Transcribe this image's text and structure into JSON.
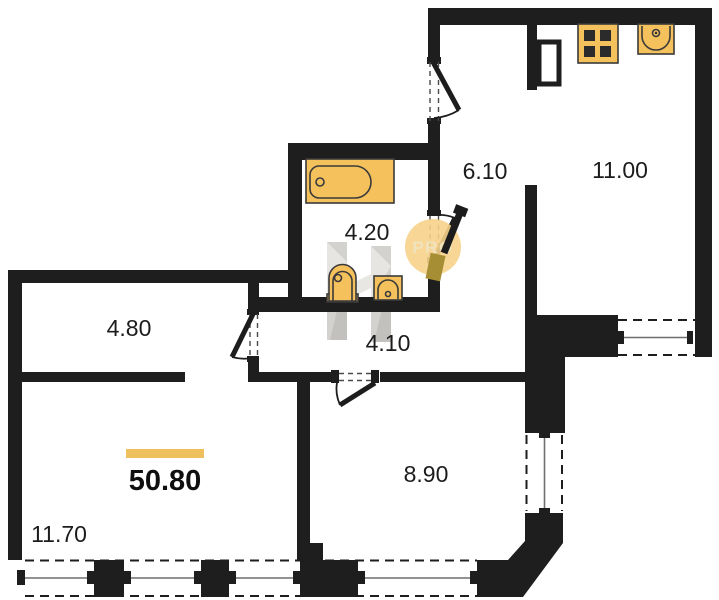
{
  "plan": {
    "title": "apartment-floor-plan",
    "total": {
      "area": "50.80"
    },
    "rooms": [
      {
        "id": "entry-hall",
        "area": "6.10"
      },
      {
        "id": "kitchen-living",
        "area": "11.00"
      },
      {
        "id": "bathroom",
        "area": "4.20"
      },
      {
        "id": "corridor",
        "area": "4.10"
      },
      {
        "id": "hallway",
        "area": "4.80"
      },
      {
        "id": "bedroom",
        "area": "8.90"
      },
      {
        "id": "living-room",
        "area": "11.70"
      }
    ],
    "watermark": {
      "badge_text": "PRO"
    },
    "fixtures": [
      "bathtub",
      "toilet",
      "bathroom-sink",
      "stove",
      "kitchen-sink",
      "ventilation-shaft"
    ],
    "colors": {
      "wall": "#1e1e1e",
      "fixture_fill": "#f4c15c",
      "accent_bar": "#efc05e",
      "badge_fill": "#f6d28b",
      "badge_text": "#f0e3bd",
      "pencil_tip": "#a68e35",
      "watermark_gray": "#b8b5b0"
    }
  }
}
